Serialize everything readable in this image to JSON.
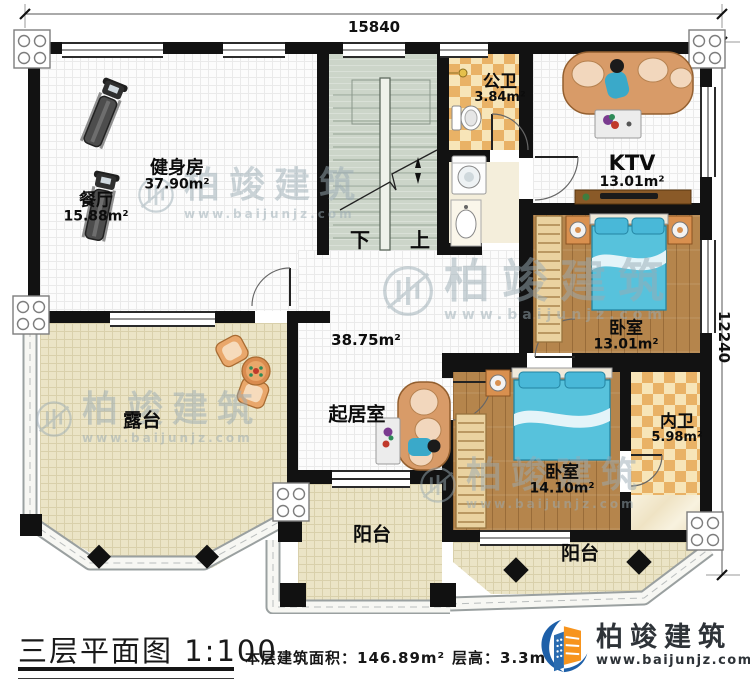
{
  "dimensions": {
    "width": "15840",
    "height": "12240"
  },
  "rooms": {
    "gym": {
      "name": "健身房",
      "area": "37.90m²"
    },
    "dining": {
      "name": "餐厅",
      "area": "15.88m²"
    },
    "public_bath": {
      "name": "公卫",
      "area": "3.84m²"
    },
    "ktv": {
      "name": "KTV",
      "area": "13.01m²"
    },
    "bedroom1": {
      "name": "卧室",
      "area": "13.01m²"
    },
    "living": {
      "name": "起居室",
      "area": "38.75m²"
    },
    "terrace": {
      "name": "露台"
    },
    "bedroom2": {
      "name": "卧室",
      "area": "14.10m²"
    },
    "ensuite_bath": {
      "name": "内卫",
      "area": "5.98m²"
    },
    "balcony_left": {
      "name": "阳台"
    },
    "balcony_right": {
      "name": "阳台"
    }
  },
  "stairs": {
    "down": "下",
    "up": "上"
  },
  "watermark": {
    "brand": "柏竣建筑",
    "site": "www.baijunjz.com"
  },
  "titleblock": {
    "plan_title": "三层平面图",
    "scale": "1:100",
    "area_label": "本层建筑面积：",
    "area_value": "146.89m²",
    "height_label": "层高：",
    "height_value": "3.3m"
  },
  "logo": {
    "brand": "柏竣建筑",
    "site": "www.baijunjz.com"
  },
  "colors": {
    "wall": "#121212",
    "wood": "#b5854c",
    "bed_blue": "#57c2dc",
    "checker_tan": "#e9b266",
    "terrace_beige": "#ebe4c6",
    "stair_green": "#ccd5c9",
    "sofa_tan": "#d89b68",
    "logo_blue": "#1d5fa8",
    "logo_orange": "#f7941d"
  }
}
